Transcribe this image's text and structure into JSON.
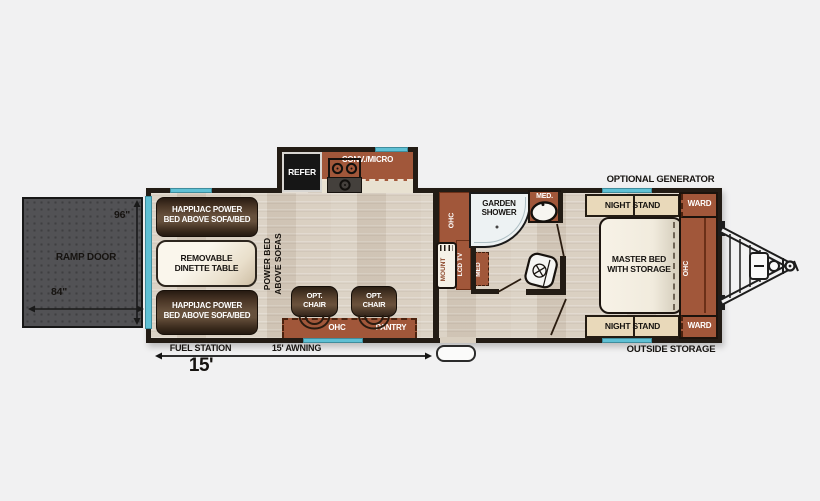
{
  "palette": {
    "background": "#f1f1f2",
    "wall": "#231c15",
    "floor": "#d8cec0",
    "cabinet_rust": "#a1573a",
    "sofa_brown": "#5c4531",
    "window_teal": "#5fc0d4",
    "ramp_gray": "#525255",
    "cream": "#e9d9ba"
  },
  "ramp": {
    "label": "RAMP DOOR",
    "height": "96\"",
    "width": "84\""
  },
  "garage": {
    "bed_top_l1": "HAPPIJAC POWER",
    "bed_top_l2": "BED ABOVE SOFA/BED",
    "dinette_l1": "REMOVABLE",
    "dinette_l2": "DINETTE TABLE",
    "bed_bottom_l1": "HAPPIJAC POWER",
    "bed_bottom_l2": "BED ABOVE SOFA/BED",
    "power_bed_l1": "POWER BED",
    "power_bed_l2": "ABOVE SOFAS"
  },
  "kitchen": {
    "refer": "REFER",
    "conv_micro": "CONV./MICRO",
    "ohc": "OHC",
    "pantry": "PANTRY",
    "chair1_l1": "OPT.",
    "chair1_l2": "CHAIR",
    "chair2_l1": "OPT.",
    "chair2_l2": "CHAIR"
  },
  "bath": {
    "ohc": "OHC",
    "lcd_tv": "LCD TV",
    "mount": "MOUNT",
    "med_cabinet": "MED",
    "shower_l1": "GARDEN",
    "shower_l2": "SHOWER",
    "med_sink": "MED."
  },
  "bedroom": {
    "night_stand_top": "NIGHT STAND",
    "night_stand_bottom": "NIGHT STAND",
    "ward_top": "WARD",
    "ward_bottom": "WARD",
    "ohc": "OHC",
    "bed_l1": "MASTER BED",
    "bed_l2": "WITH STORAGE"
  },
  "exterior": {
    "optional_generator": "OPTIONAL GENERATOR",
    "outside_storage": "OUTSIDE STORAGE",
    "fuel_station": "FUEL STATION",
    "awning": "15' AWNING",
    "length": "15'"
  }
}
